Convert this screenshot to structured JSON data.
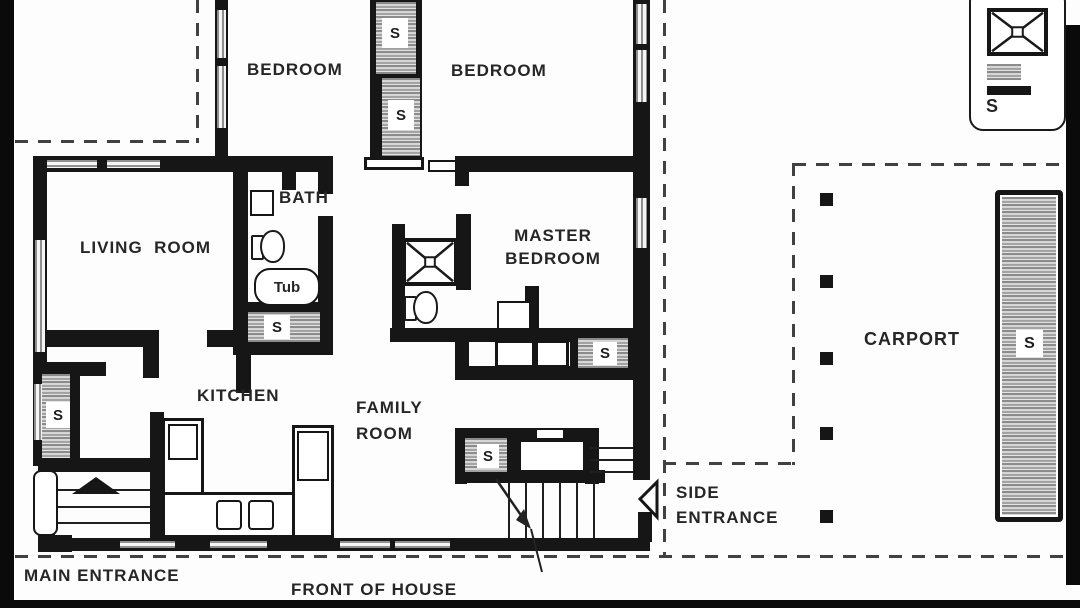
{
  "rooms": {
    "bedroom1": "BEDROOM",
    "bedroom2": "BEDROOM",
    "living_room": "LIVING  ROOM",
    "bath": "BATH",
    "master_line1": "MASTER",
    "master_line2": "BEDROOM",
    "kitchen": "KITCHEN",
    "family_line1": "FAMILY",
    "family_line2": "ROOM",
    "carport": "CARPORT"
  },
  "fixtures": {
    "tub": "Tub",
    "storage": "S"
  },
  "annotations": {
    "main_entrance": "MAIN ENTRANCE",
    "front_of_house": "FRONT OF HOUSE",
    "side_line1": "SIDE",
    "side_line2": "ENTRANCE"
  },
  "legend": {
    "shower_symbol": "shower-pan-symbol",
    "closet_symbol": "shelf-closet-symbol",
    "wall_symbol": "solid-wall-symbol",
    "storage": "S"
  },
  "colors": {
    "wall": "#161616",
    "hatch_gray": "#8b8b8b",
    "window_gray": "#8f8f8f",
    "dash": "#414141",
    "paper": "#fdfdfd",
    "text": "#262626"
  }
}
